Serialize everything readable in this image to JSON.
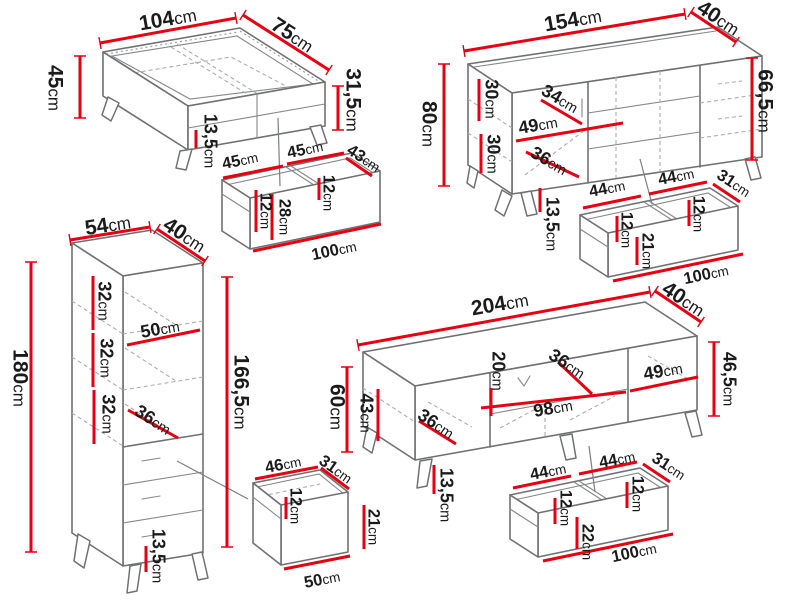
{
  "diagram": {
    "kind": "furniture-dimensions-diagram",
    "unit": "cm",
    "colors": {
      "dimension_line": "#e60011",
      "outline": "#6f7173",
      "hidden_line": "#aaacae",
      "text": "#1b1b1b",
      "background": "#ffffff"
    }
  },
  "items": [
    {
      "id": "coffee-table",
      "name": "Coffee table",
      "labels": [
        {
          "n": "104",
          "u": "cm"
        },
        {
          "n": "75",
          "u": "cm"
        },
        {
          "n": "45",
          "u": "cm"
        },
        {
          "n": "31,5",
          "u": "cm"
        },
        {
          "n": "13,5",
          "u": "cm"
        }
      ]
    },
    {
      "id": "coffee-table-drawer",
      "name": "Coffee table drawer (interior)",
      "labels": [
        {
          "n": "45",
          "u": "cm"
        },
        {
          "n": "45",
          "u": "cm"
        },
        {
          "n": "43",
          "u": "cm"
        },
        {
          "n": "12",
          "u": "cm"
        },
        {
          "n": "28",
          "u": "cm"
        },
        {
          "n": "12",
          "u": "cm"
        },
        {
          "n": "100",
          "u": "cm"
        }
      ]
    },
    {
      "id": "sideboard",
      "name": "Sideboard",
      "labels": [
        {
          "n": "154",
          "u": "cm"
        },
        {
          "n": "40",
          "u": "cm"
        },
        {
          "n": "80",
          "u": "cm"
        },
        {
          "n": "66,5",
          "u": "cm"
        },
        {
          "n": "30",
          "u": "cm"
        },
        {
          "n": "30",
          "u": "cm"
        },
        {
          "n": "34",
          "u": "cm"
        },
        {
          "n": "49",
          "u": "cm"
        },
        {
          "n": "36",
          "u": "cm"
        },
        {
          "n": "13,5",
          "u": "cm"
        }
      ]
    },
    {
      "id": "sideboard-drawers",
      "name": "Sideboard drawers (interior)",
      "labels": [
        {
          "n": "44",
          "u": "cm"
        },
        {
          "n": "44",
          "u": "cm"
        },
        {
          "n": "31",
          "u": "cm"
        },
        {
          "n": "12",
          "u": "cm"
        },
        {
          "n": "12",
          "u": "cm"
        },
        {
          "n": "21",
          "u": "cm"
        },
        {
          "n": "100",
          "u": "cm"
        }
      ]
    },
    {
      "id": "tall-cabinet",
      "name": "Tall cabinet",
      "labels": [
        {
          "n": "54",
          "u": "cm"
        },
        {
          "n": "40",
          "u": "cm"
        },
        {
          "n": "180",
          "u": "cm"
        },
        {
          "n": "166,5",
          "u": "cm"
        },
        {
          "n": "32",
          "u": "cm"
        },
        {
          "n": "32",
          "u": "cm"
        },
        {
          "n": "32",
          "u": "cm"
        },
        {
          "n": "50",
          "u": "cm"
        },
        {
          "n": "36",
          "u": "cm"
        },
        {
          "n": "13,5",
          "u": "cm"
        }
      ]
    },
    {
      "id": "cabinet-drawer",
      "name": "Cabinet drawer (interior)",
      "labels": [
        {
          "n": "46",
          "u": "cm"
        },
        {
          "n": "31",
          "u": "cm"
        },
        {
          "n": "12",
          "u": "cm"
        },
        {
          "n": "21",
          "u": "cm"
        },
        {
          "n": "50",
          "u": "cm"
        }
      ]
    },
    {
      "id": "tv-stand",
      "name": "TV stand",
      "labels": [
        {
          "n": "204",
          "u": "cm"
        },
        {
          "n": "40",
          "u": "cm"
        },
        {
          "n": "60",
          "u": "cm"
        },
        {
          "n": "43",
          "u": "cm"
        },
        {
          "n": "46,5",
          "u": "cm"
        },
        {
          "n": "20",
          "u": "cm"
        },
        {
          "n": "36",
          "u": "cm"
        },
        {
          "n": "49",
          "u": "cm"
        },
        {
          "n": "98",
          "u": "cm"
        },
        {
          "n": "36",
          "u": "cm"
        },
        {
          "n": "13,5",
          "u": "cm"
        }
      ]
    },
    {
      "id": "tv-stand-drawers",
      "name": "TV stand drawers (interior)",
      "labels": [
        {
          "n": "44",
          "u": "cm"
        },
        {
          "n": "44",
          "u": "cm"
        },
        {
          "n": "31",
          "u": "cm"
        },
        {
          "n": "12",
          "u": "cm"
        },
        {
          "n": "12",
          "u": "cm"
        },
        {
          "n": "22",
          "u": "cm"
        },
        {
          "n": "100",
          "u": "cm"
        }
      ]
    }
  ]
}
